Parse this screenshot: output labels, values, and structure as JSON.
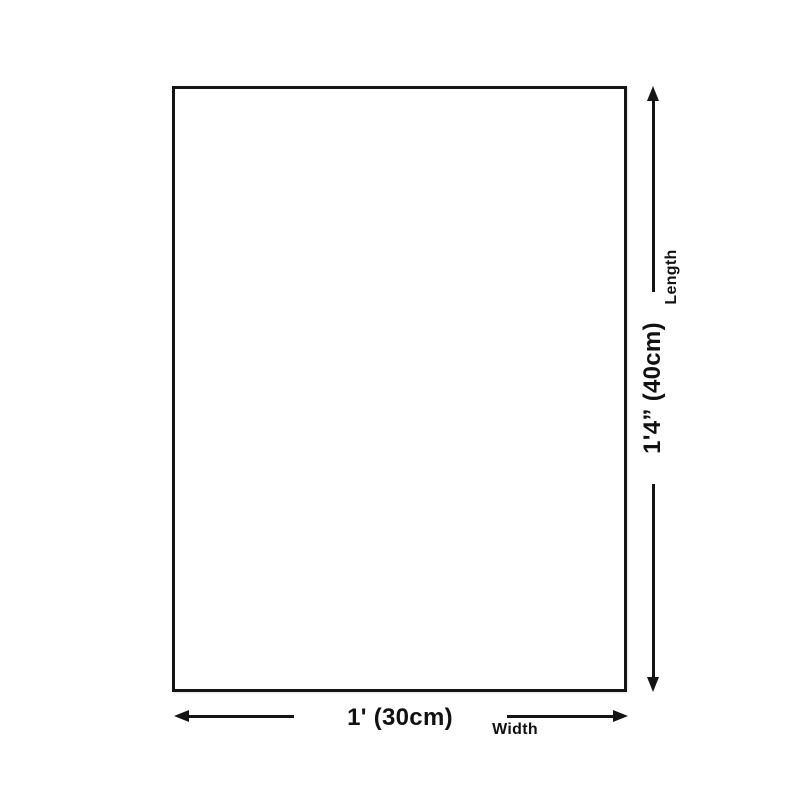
{
  "page": {
    "background_color": "#ffffff",
    "line_color": "#141414",
    "text_color": "#111111"
  },
  "diagram": {
    "type": "product-size-diagram",
    "shape": "rectangle",
    "width": {
      "value": "1' (30cm)",
      "label": "Width"
    },
    "length": {
      "value": "1'4” (40cm)",
      "label": "Length"
    }
  }
}
